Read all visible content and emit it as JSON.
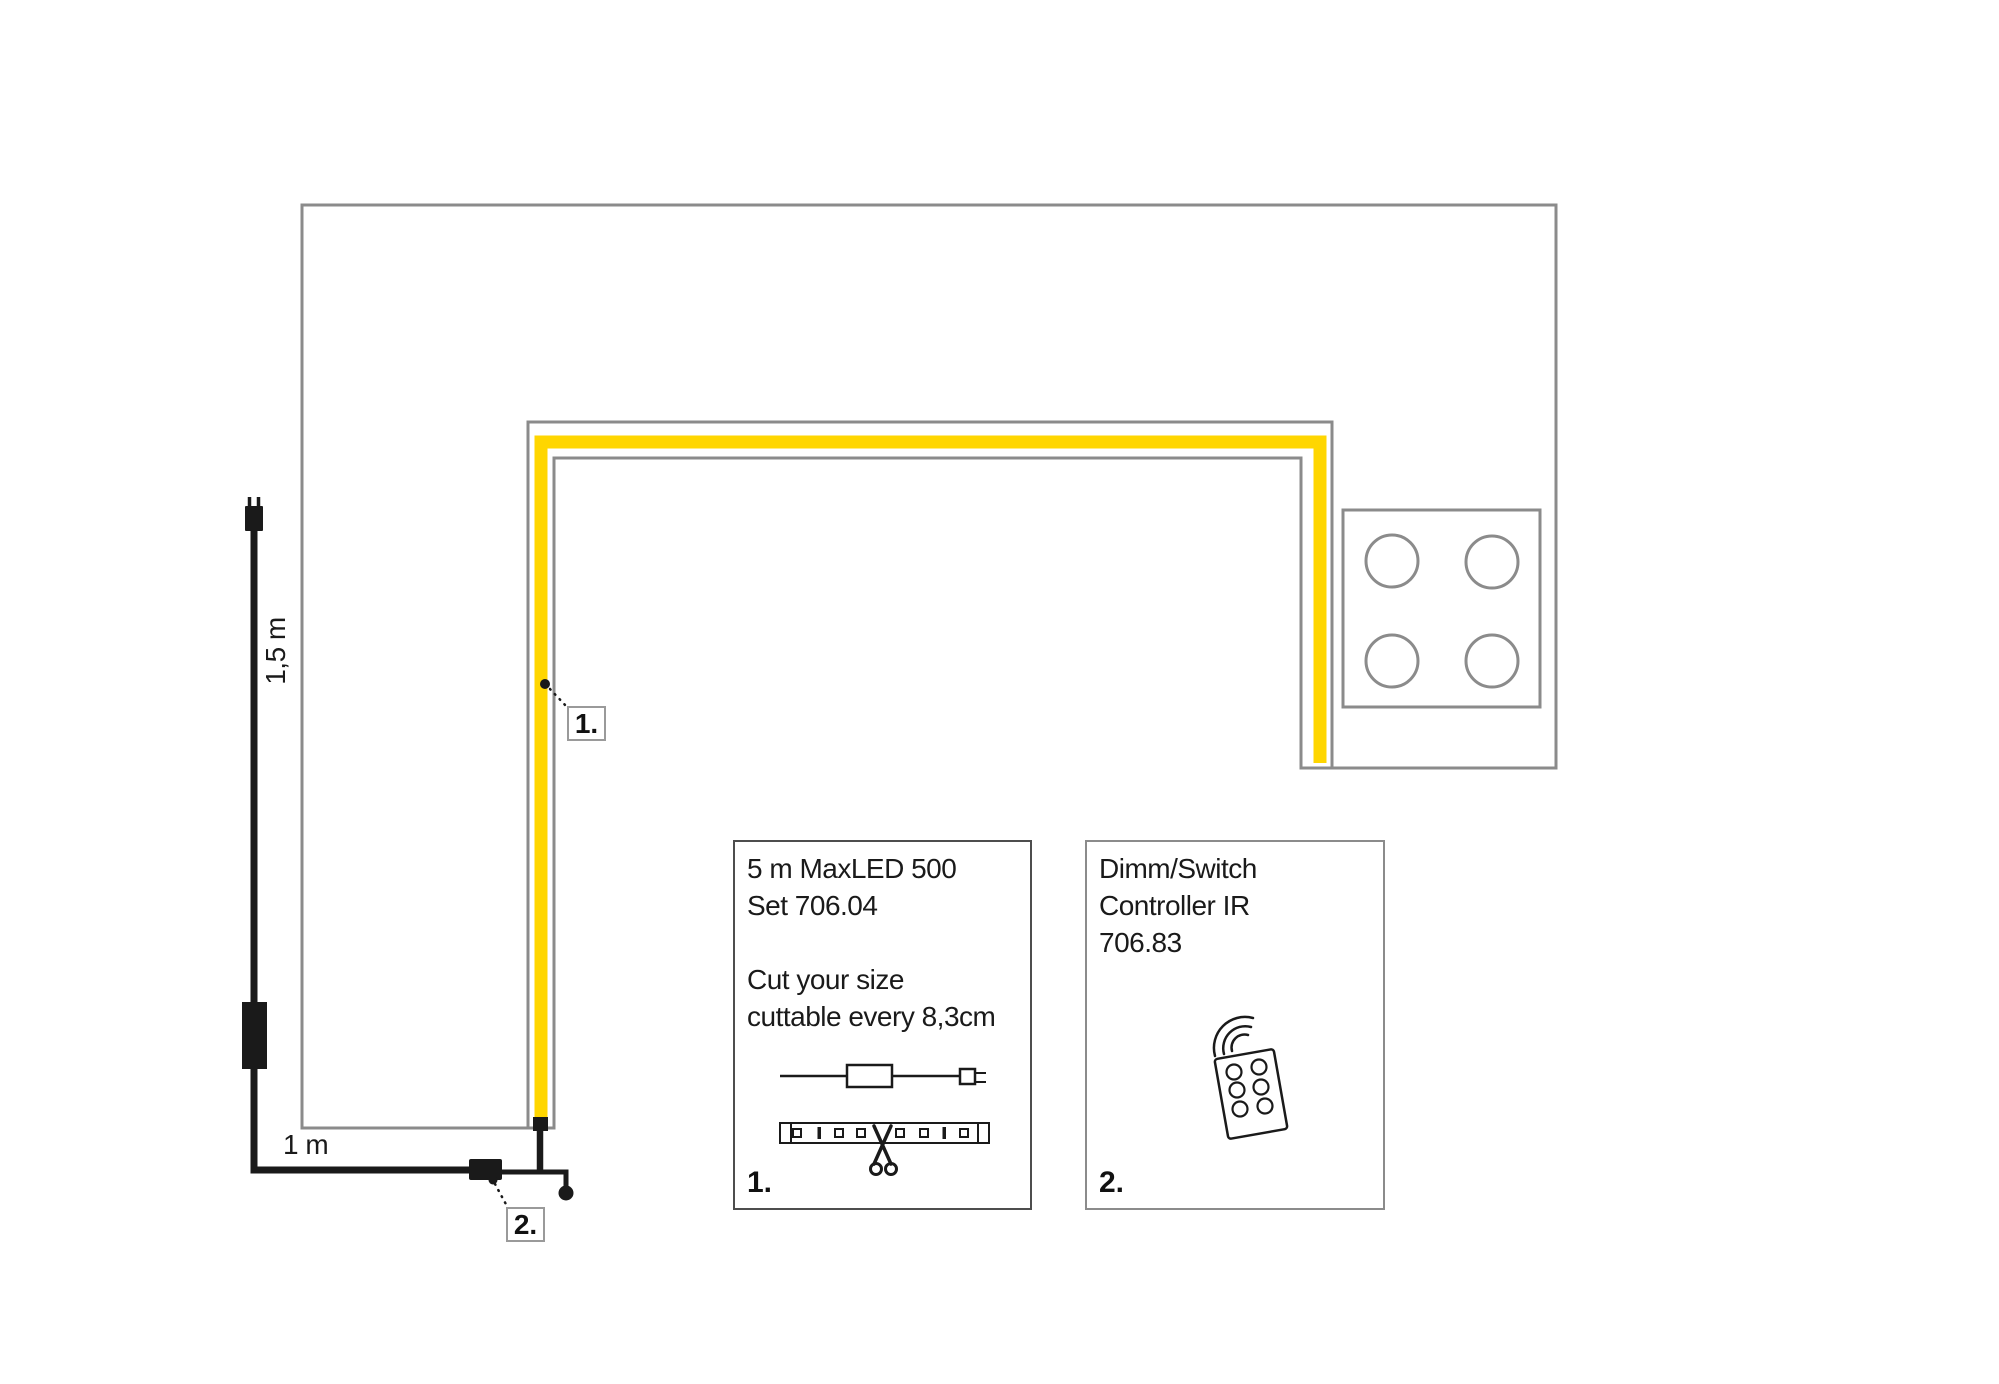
{
  "diagram": {
    "colors": {
      "outline_gray": "#8b8b8b",
      "strip_yellow": "#ffd600",
      "cable_black": "#1a1a1a",
      "text_black": "#1a1a1a"
    },
    "labels": {
      "vertical_cable_length": "1,5 m",
      "horizontal_cable_length": "1 m"
    },
    "callouts": {
      "one": "1.",
      "two": "2."
    },
    "info_box_1": {
      "text": "5 m MaxLED 500\nSet 706.04\n\nCut your size\ncuttable every 8,3cm",
      "number": "1."
    },
    "info_box_2": {
      "text": "Dimm/Switch\nController IR\n706.83",
      "number": "2."
    },
    "icons": {
      "power_plug": "two-prong plug shape",
      "inline_driver": "solid black rectangle on cable",
      "controller_box": "solid black rectangle connector",
      "ir_receiver": "ball on short cable",
      "cooktop": "square with four burner circles",
      "led_strip_cuttable": "strip with LED squares and cut marks",
      "scissors": "crossed blades with two handle loops",
      "remote_control": "tilted remote with six buttons",
      "ir_waves": "three concentric arcs"
    }
  }
}
